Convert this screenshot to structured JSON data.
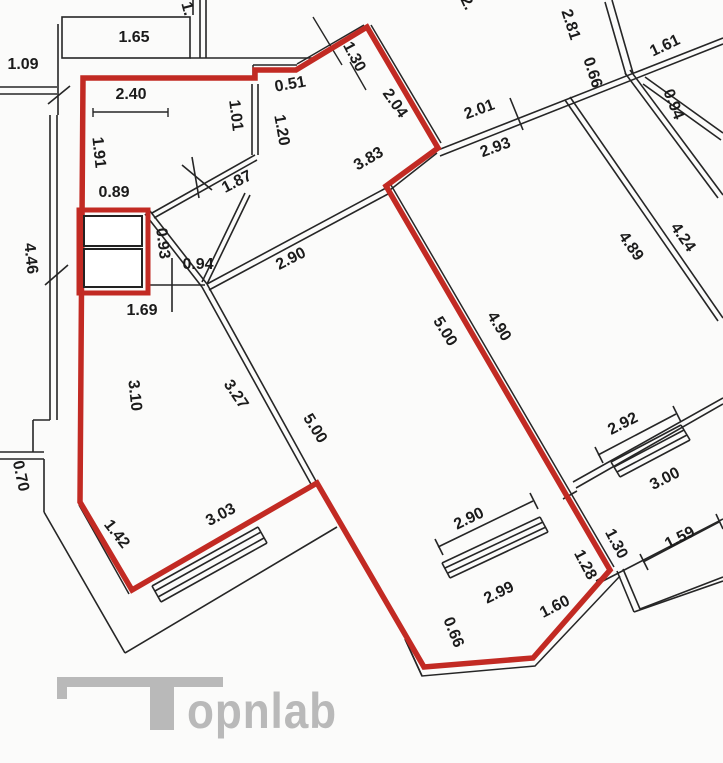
{
  "title": "Apartment floor plan with highlighted unit",
  "colors": {
    "outline_red": "#c22a23",
    "walls_black": "#262626",
    "label_text": "#1b1b1b",
    "watermark_gray": "#b9b9b9",
    "background": "#fbfbfa"
  },
  "watermark": {
    "text": "opnlab"
  },
  "plan": {
    "dimension_labels": [
      {
        "text": "1.65",
        "x": 134,
        "y": 42,
        "r": 0
      },
      {
        "text": "1.",
        "x": 183,
        "y": 10,
        "r": 75
      },
      {
        "text": "1.09",
        "x": 23,
        "y": 69,
        "r": 0
      },
      {
        "text": "2.40",
        "x": 131,
        "y": 99,
        "r": 0
      },
      {
        "text": "1.91",
        "x": 94,
        "y": 153,
        "r": 84
      },
      {
        "text": "0.89",
        "x": 114,
        "y": 197,
        "r": 0
      },
      {
        "text": "0.51",
        "x": 291,
        "y": 89,
        "r": -10
      },
      {
        "text": "1.30",
        "x": 350,
        "y": 59,
        "r": 62
      },
      {
        "text": "2.04",
        "x": 391,
        "y": 106,
        "r": 55
      },
      {
        "text": "1.01",
        "x": 231,
        "y": 116,
        "r": 83
      },
      {
        "text": "1.20",
        "x": 277,
        "y": 131,
        "r": 80
      },
      {
        "text": "1.87",
        "x": 239,
        "y": 186,
        "r": -27
      },
      {
        "text": "3.83",
        "x": 371,
        "y": 163,
        "r": -30
      },
      {
        "text": "0.93",
        "x": 158,
        "y": 244,
        "r": 83
      },
      {
        "text": "0.94",
        "x": 198,
        "y": 269,
        "r": 0
      },
      {
        "text": "1.69",
        "x": 142,
        "y": 315,
        "r": 0
      },
      {
        "text": "2.90",
        "x": 293,
        "y": 263,
        "r": -27
      },
      {
        "text": "4.46",
        "x": 26,
        "y": 259,
        "r": 84
      },
      {
        "text": "3.10",
        "x": 130,
        "y": 396,
        "r": 84
      },
      {
        "text": "3.27",
        "x": 232,
        "y": 397,
        "r": 56
      },
      {
        "text": "5.00",
        "x": 311,
        "y": 431,
        "r": 58
      },
      {
        "text": "0.70",
        "x": 16,
        "y": 477,
        "r": 78
      },
      {
        "text": "1.42",
        "x": 113,
        "y": 537,
        "r": 52
      },
      {
        "text": "3.03",
        "x": 223,
        "y": 519,
        "r": -28
      },
      {
        "text": "2.01",
        "x": 481,
        "y": 114,
        "r": -20
      },
      {
        "text": "2.93",
        "x": 497,
        "y": 152,
        "r": -20
      },
      {
        "text": "5.00",
        "x": 441,
        "y": 334,
        "r": 58
      },
      {
        "text": "4.90",
        "x": 495,
        "y": 329,
        "r": 58
      },
      {
        "text": "2.81",
        "x": 566,
        "y": 26,
        "r": 72
      },
      {
        "text": "0.66",
        "x": 588,
        "y": 74,
        "r": 72
      },
      {
        "text": "1.61",
        "x": 667,
        "y": 50,
        "r": -25
      },
      {
        "text": "0.94",
        "x": 669,
        "y": 106,
        "r": 68
      },
      {
        "text": "4.89",
        "x": 627,
        "y": 249,
        "r": 55
      },
      {
        "text": "4.24",
        "x": 679,
        "y": 240,
        "r": 55
      },
      {
        "text": "2.92",
        "x": 625,
        "y": 428,
        "r": -27
      },
      {
        "text": "3.00",
        "x": 667,
        "y": 483,
        "r": -27
      },
      {
        "text": "1.59",
        "x": 682,
        "y": 542,
        "r": -27
      },
      {
        "text": "1.30",
        "x": 612,
        "y": 546,
        "r": 62
      },
      {
        "text": "1.28",
        "x": 581,
        "y": 567,
        "r": 62
      },
      {
        "text": "2.90",
        "x": 471,
        "y": 523,
        "r": -26
      },
      {
        "text": "2.99",
        "x": 501,
        "y": 597,
        "r": -26
      },
      {
        "text": "0.66",
        "x": 449,
        "y": 634,
        "r": 68
      },
      {
        "text": "1.60",
        "x": 557,
        "y": 611,
        "r": -27
      },
      {
        "text": "2.",
        "x": 463,
        "y": 5,
        "r": 65
      }
    ]
  }
}
